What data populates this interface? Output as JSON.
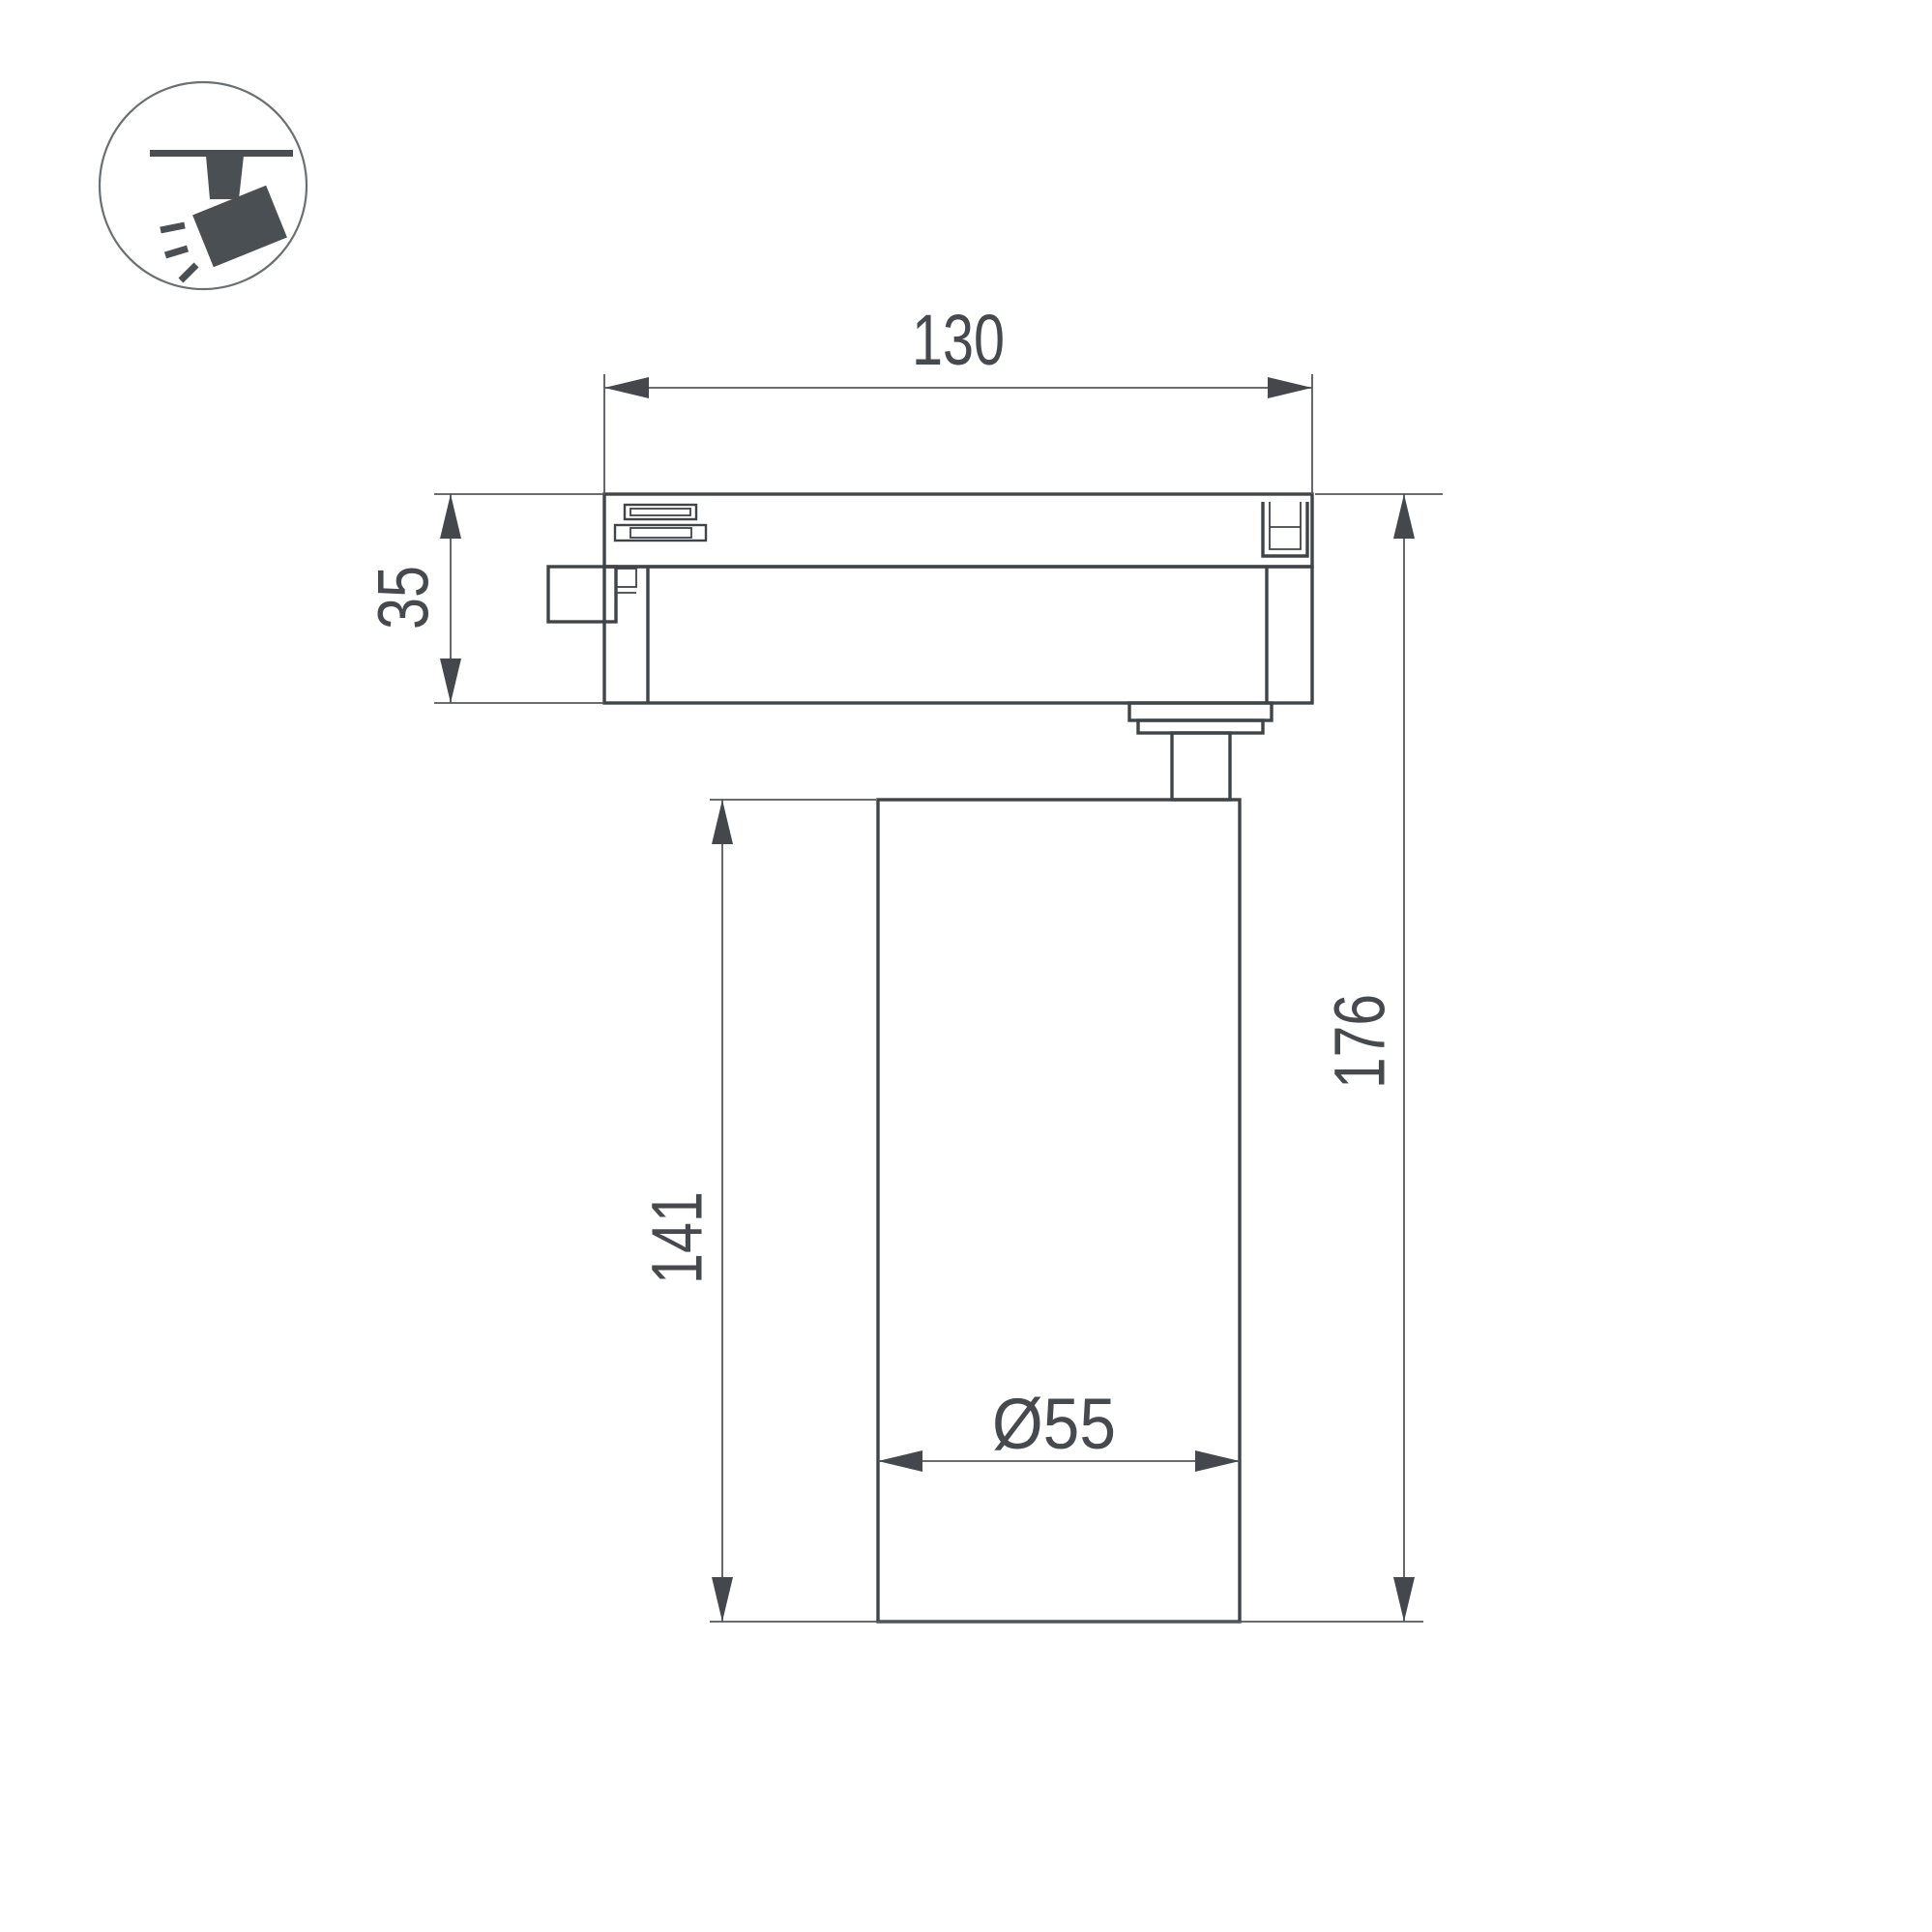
{
  "page": {
    "background": "#ffffff"
  },
  "colors": {
    "part_outline": "#3f4449",
    "dimension_line": "#54585c",
    "arrowhead": "#44484c",
    "label_text": "#464a4e",
    "icon_fill": "#4a4f54",
    "icon_circle_border": "#6a6f73"
  },
  "icon": {
    "name": "track-spotlight-icon"
  },
  "dimensions": {
    "track_adapter_width": "130",
    "track_adapter_height": "35",
    "lamp_body_height": "141",
    "overall_height": "176",
    "lamp_body_diameter": "Ø55"
  }
}
